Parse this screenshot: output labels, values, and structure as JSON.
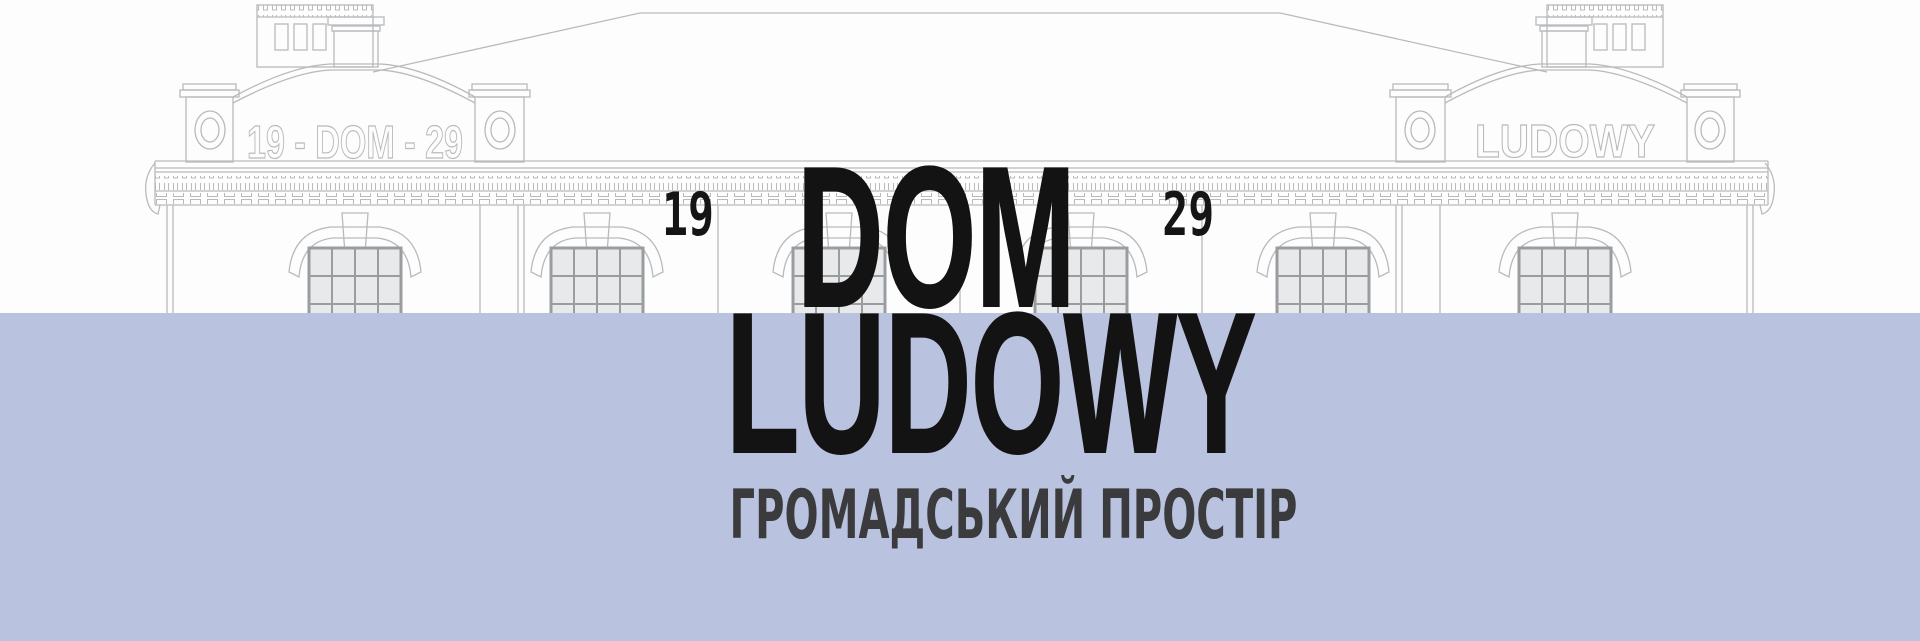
{
  "hero": {
    "year_left": "19",
    "year_right": "29",
    "title_line1": "DOM",
    "title_line2": "LUDOWY",
    "subtitle": "ГРОМАДСЬКИЙ ПРОСТІР"
  },
  "building": {
    "left_pediment_text": "19 - DOM - 29",
    "right_pediment_text": "LUDOWY"
  },
  "colors": {
    "background": "#fdfdfd",
    "band": "#b9c2de",
    "title": "#131313",
    "subtitle": "#3b3b3d",
    "line_art": "#b8babd",
    "window_frame": "#9a9da0",
    "window_glass": "#e8e9ea"
  }
}
